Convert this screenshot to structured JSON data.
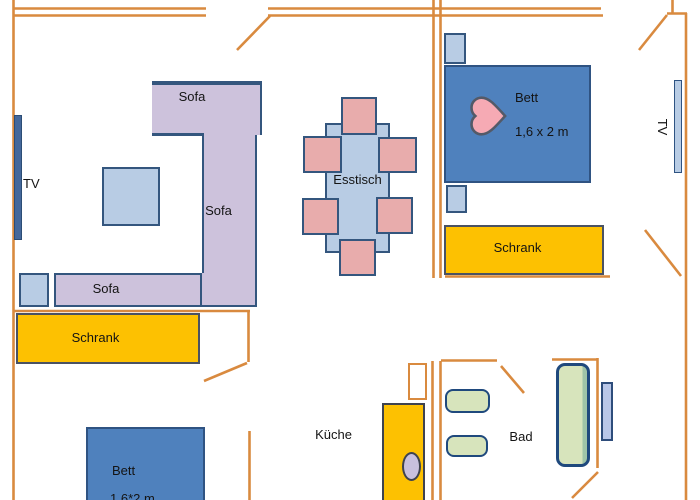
{
  "plan_title": "apartment-floor-plan",
  "palette": {
    "wall_orange": "#d98a3f",
    "sofa_lavender": "#cdc2dc",
    "light_blue": "#b8cce4",
    "bed_blue": "#4f81bd",
    "wardrobe_yellow": "#fdc101",
    "chair_pink": "#e8acac",
    "fixture_green": "#d7e4bc",
    "outline_dark_blue": "#34567e",
    "heart_pink": "#f6aab4"
  },
  "living_room": {
    "tv_label": "TV",
    "sofa_top_label": "Sofa",
    "sofa_right_label": "Sofa",
    "sofa_bottom_label": "Sofa"
  },
  "dining": {
    "table_label": "Esstisch"
  },
  "bedroom_main": {
    "bed_label": "Bett",
    "bed_size": "1,6 x 2 m",
    "wardrobe_label": "Schrank",
    "tv_label": "TV",
    "heart_icon": "heart"
  },
  "bedroom_second": {
    "bed_label": "Bett",
    "bed_size": "1,6*2 m",
    "wardrobe_label": "Schrank"
  },
  "kitchen": {
    "label": "Küche"
  },
  "bathroom": {
    "label": "Bad"
  }
}
